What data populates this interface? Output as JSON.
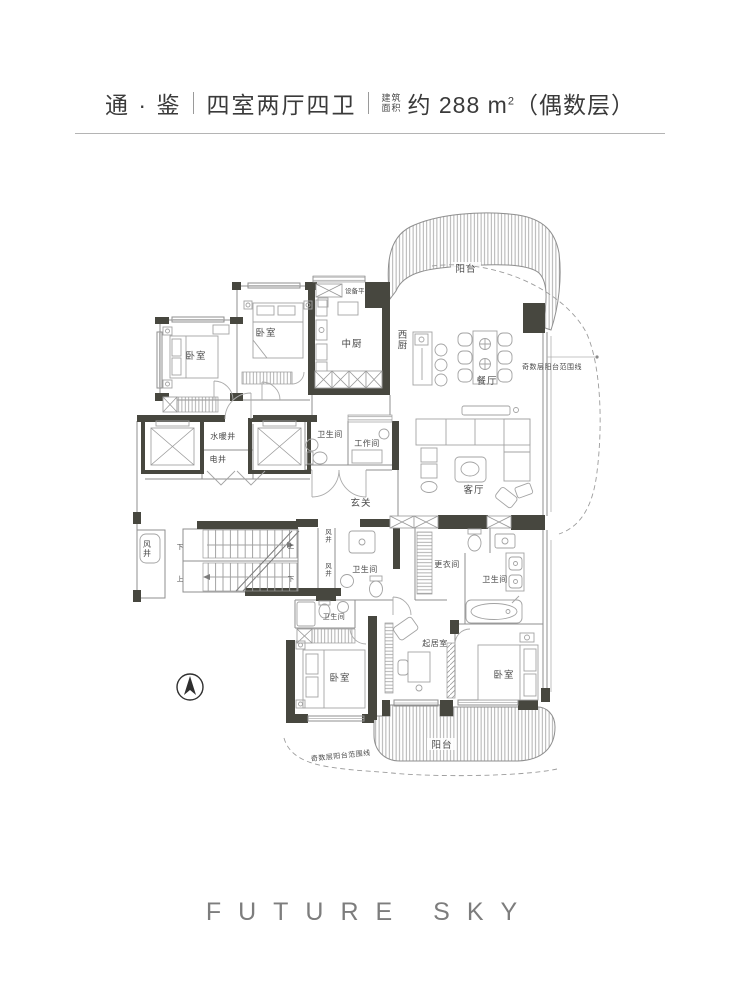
{
  "header": {
    "project": "通 · 鉴",
    "layout": "四室两厅四卫",
    "area_label_line1": "建筑",
    "area_label_line2": "面积",
    "area_about": "约",
    "area_number": "288",
    "area_unit_base": "m",
    "area_unit_sup": "2",
    "area_suffix": "（偶数层）"
  },
  "plan": {
    "labels": {
      "balcony_top": "阳台",
      "equipment_platform": "设备平台",
      "bedroom_top_left": "卧室",
      "bedroom_top_mid": "卧室",
      "kitchen_chinese": "中厨",
      "kitchen_western": "西厨",
      "dining": "餐厅",
      "odd_floor_line_right": "奇数层阳台范围线",
      "water_heating_shaft": "水暖井",
      "electric_shaft": "电井",
      "bath_top": "卫生间",
      "workroom": "工作间",
      "foyer": "玄关",
      "living": "客厅",
      "wind_shaft_left": "风井",
      "wind_shaft_mid_1": "风井",
      "wind_shaft_mid_2": "风井",
      "bath_mid": "卫生间",
      "bath_lower": "卫生间",
      "dressing_room": "更衣间",
      "bath_right": "卫生间",
      "sitting_room": "起居室",
      "bedroom_bottom_left": "卧室",
      "bedroom_bottom_right": "卧室",
      "balcony_bottom": "阳台",
      "odd_floor_line_bottom": "奇数层阳台范围线",
      "stair_down_1": "下",
      "stair_up_1": "上",
      "stair_up_2": "上",
      "stair_down_2": "下"
    },
    "icons": {
      "compass": "north-arrow"
    }
  },
  "footer": {
    "brand": "FUTURE SKY"
  }
}
